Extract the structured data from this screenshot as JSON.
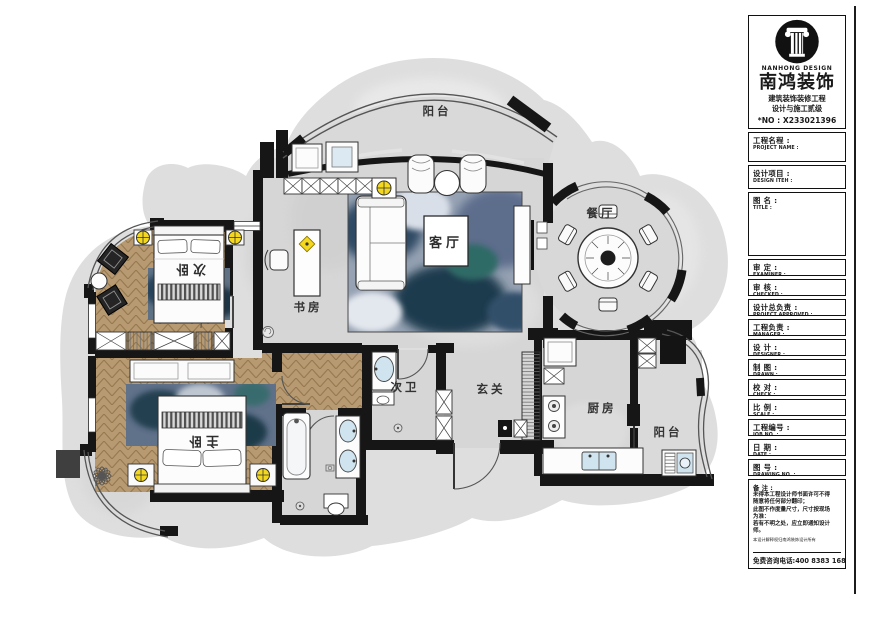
{
  "floor_plan": {
    "rooms": [
      {
        "id": "balcony-top",
        "label": "阳台"
      },
      {
        "id": "living-room",
        "label": "客厅"
      },
      {
        "id": "dining-room",
        "label": "餐厅"
      },
      {
        "id": "bedroom-second",
        "label": "次卧"
      },
      {
        "id": "study",
        "label": "书房"
      },
      {
        "id": "bath-second",
        "label": "次卫"
      },
      {
        "id": "entry-hall",
        "label": "玄关"
      },
      {
        "id": "kitchen",
        "label": "厨房"
      },
      {
        "id": "bedroom-master",
        "label": "主卧"
      },
      {
        "id": "balcony-side",
        "label": "阳台"
      }
    ],
    "colors": {
      "wall": "#161616",
      "floor_stone": "#d6d6d6",
      "floor_wood": "#b79a71",
      "rug_blue": "#2e4a63",
      "lamp_yellow": "#f4d81f",
      "fixture_blue": "#cfe4ef"
    }
  },
  "title_block": {
    "logo": {
      "brand_en": "NANHONG DESIGN",
      "brand_cn": "南鸿装饰",
      "qualification_line1": "建筑装饰装修工程",
      "qualification_line2": "设计与施工贰级",
      "license_no": "*NO : X233021396"
    },
    "fields": [
      {
        "cn": "工程名程 :",
        "en": "PROJECT NAME :"
      },
      {
        "cn": "设计项目 :",
        "en": "DESIGN ITEH :"
      },
      {
        "cn": "图 名 :",
        "en": "TITLE :"
      },
      {
        "cn": "审 定 :",
        "en": "EXAMINER :"
      },
      {
        "cn": "审 核 :",
        "en": "CHECKED :"
      },
      {
        "cn": "设计总负责 :",
        "en": "PROJECT APPROVED :"
      },
      {
        "cn": "工程负责 :",
        "en": "MANAGER :"
      },
      {
        "cn": "设 计 :",
        "en": "DESIGNER :"
      },
      {
        "cn": "制 图 :",
        "en": "DRAWN :"
      },
      {
        "cn": "校 对 :",
        "en": "CHECK :"
      },
      {
        "cn": "比 例 :",
        "en": "SCALE :"
      },
      {
        "cn": "工程编号 :",
        "en": "JOB NO. :"
      },
      {
        "cn": "日 期 :",
        "en": "DATE :"
      },
      {
        "cn": "图 号 :",
        "en": "DRAWING NO. :"
      }
    ],
    "remarks": {
      "heading": "备 注 :",
      "lines": [
        "未得本工程设计师书面许可不得",
        "随意将任何部分翻印；",
        "此图不作度量尺寸，尺寸按现场",
        "为准：",
        "若有不明之处，应立即通知设计",
        "师。"
      ],
      "tiny": "本设计解释权归南鸿装饰设计所有",
      "hotline": "免费咨询电话:400 8383 168"
    }
  }
}
